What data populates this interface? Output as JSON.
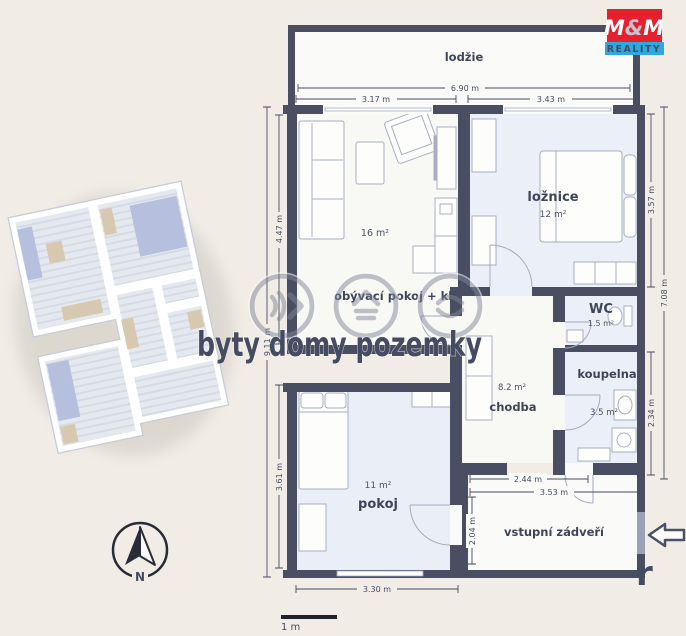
{
  "branding": {
    "m1": "M",
    "amp": "&",
    "m2": "M",
    "reality": "REALITY",
    "red": "#e6212f",
    "blue": "#2ba9e0"
  },
  "watermark": {
    "text": "byty domy pozemky",
    "fragment": "r"
  },
  "compass": {
    "north_label": "N"
  },
  "scale_bar": {
    "label": "1 m"
  },
  "rooms": {
    "loggia": {
      "label": "lodžie"
    },
    "living": {
      "label": "obývací pokoj + kk",
      "area": "16 m²"
    },
    "bedroom": {
      "label": "ložnice",
      "area": "12 m²"
    },
    "wc": {
      "label": "WC",
      "area": "1.5 m²"
    },
    "bathroom": {
      "label": "koupelna",
      "area": "3.5 m²"
    },
    "hall": {
      "label": "chodba",
      "area": "8.2 m²"
    },
    "room": {
      "label": "pokoj",
      "area": "11 m²"
    },
    "vestibule": {
      "label": "vstupní zádveří"
    }
  },
  "dimensions": {
    "loggia_width": "6.90 m",
    "living_width": "3.17 m",
    "bedroom_width": "3.43 m",
    "living_depth": "4.47 m",
    "left_total": "9.11 m",
    "room_depth": "3.61 m",
    "bedroom_depth": "3.57 m",
    "right_total": "7.08 m",
    "bathroom_depth": "2.34 m",
    "vestibule_inner_width": "2.44 m",
    "vestibule_width": "3.53 m",
    "vestibule_depth": "2.04 m",
    "room_width": "3.30 m"
  },
  "colors": {
    "background": "#f1ede6",
    "wall": "#494e62",
    "room_white": "#f8f8f5",
    "room_blue": "#ebeff7"
  }
}
